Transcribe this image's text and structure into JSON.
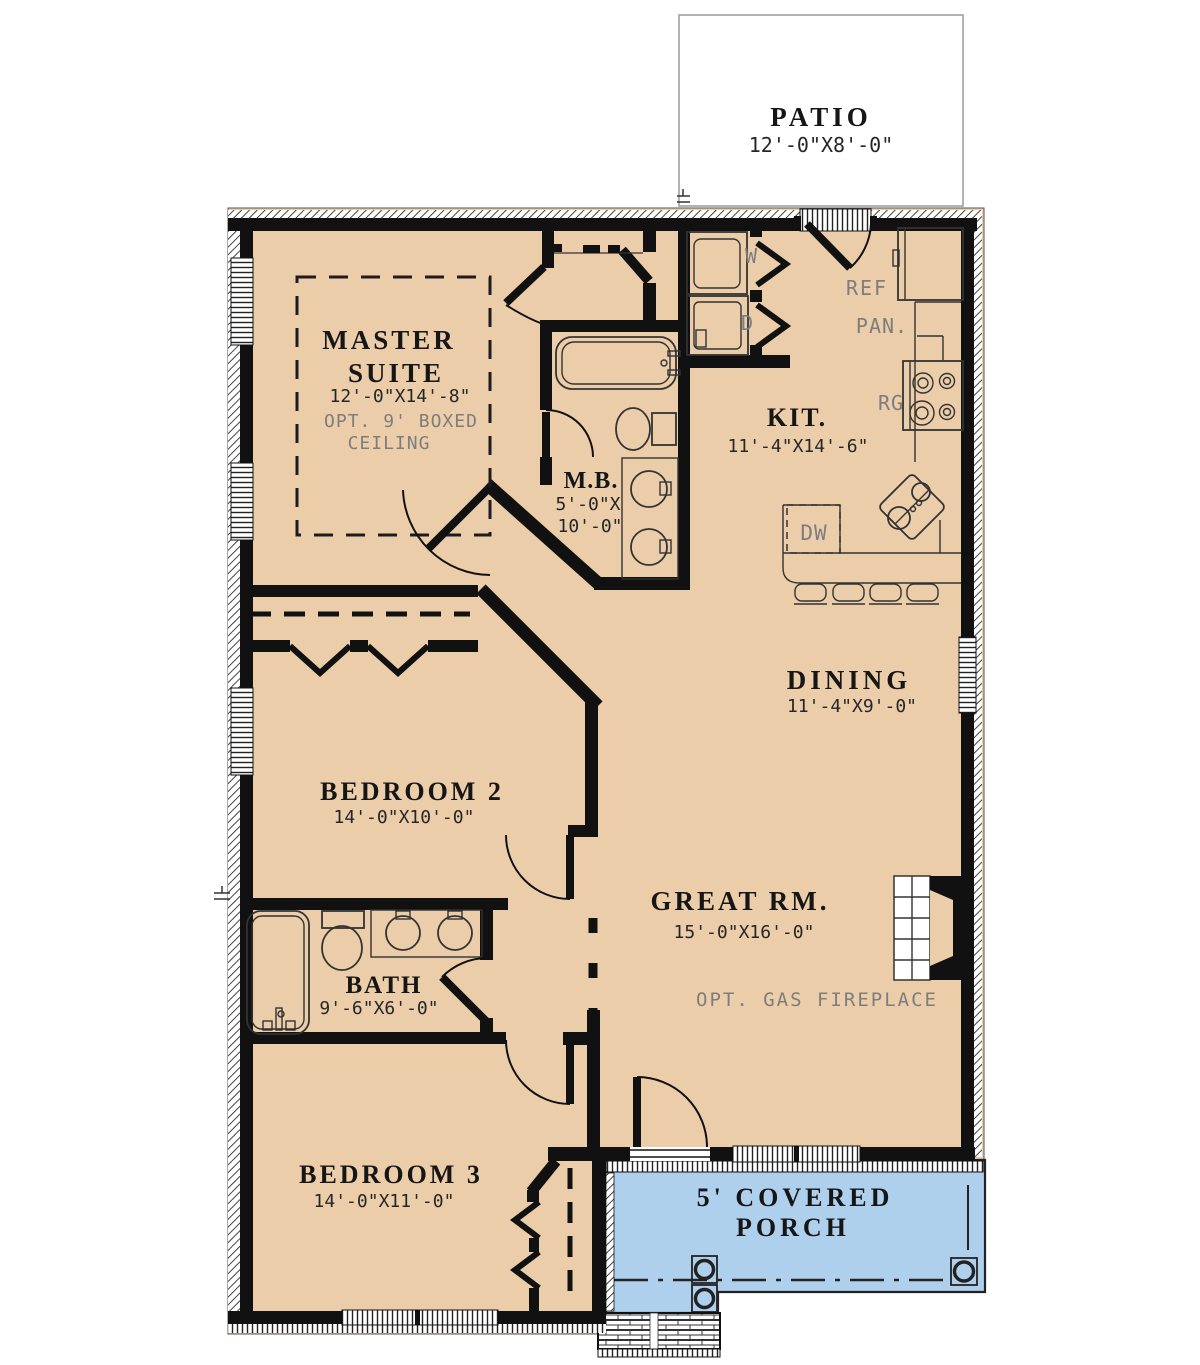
{
  "colors": {
    "floor": "#eccdaa",
    "porch": "#aed0ec",
    "wall": "#111111",
    "annotation": "#7d7d7d",
    "patio_border": "#9a9a9a"
  },
  "patio": {
    "name": "PATIO",
    "dims": "12'-0\"X8'-0\""
  },
  "rooms": {
    "master": {
      "name_line1": "MASTER",
      "name_line2": "SUITE",
      "dims": "12'-0\"X14'-8\"",
      "note_line1": "OPT. 9' BOXED",
      "note_line2": "CEILING"
    },
    "master_bath": {
      "name": "M.B.",
      "dims_line1": "5'-0\"X",
      "dims_line2": "10'-0\""
    },
    "kitchen": {
      "name": "KIT.",
      "dims": "11'-4\"X14'-6\""
    },
    "dining": {
      "name": "DINING",
      "dims": "11'-4\"X9'-0\""
    },
    "great_room": {
      "name": "GREAT RM.",
      "dims": "15'-0\"X16'-0\"",
      "note": "OPT. GAS FIREPLACE"
    },
    "bedroom2": {
      "name": "BEDROOM 2",
      "dims": "14'-0\"X10'-0\""
    },
    "bath": {
      "name": "BATH",
      "dims": "9'-6\"X6'-0\""
    },
    "bedroom3": {
      "name": "BEDROOM 3",
      "dims": "14'-0\"X11'-0\""
    },
    "porch": {
      "name_line1": "5' COVERED",
      "name_line2": "PORCH"
    }
  },
  "appliances": {
    "washer": "W",
    "dryer": "D",
    "refrigerator": "REF",
    "pantry": "PAN.",
    "range": "RG",
    "dishwasher": "DW"
  }
}
